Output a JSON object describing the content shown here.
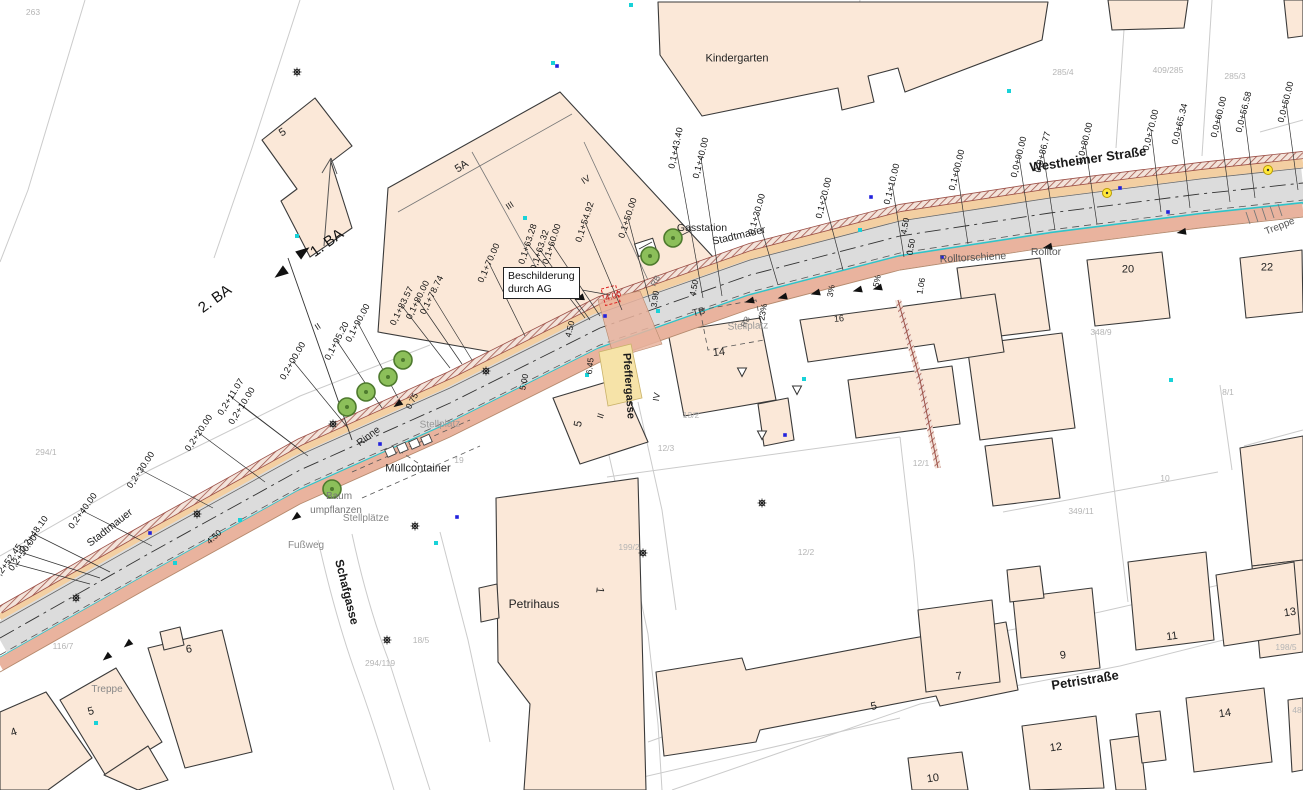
{
  "map": {
    "title": "Lageplan",
    "sign_box": {
      "line1": "Beschilderung",
      "line2": "durch AG",
      "x": 503,
      "y": 267,
      "w": 72,
      "h": 30
    },
    "streets": [
      {
        "label": "Westheimer Straße",
        "x": 1088,
        "y": 159,
        "rot": -8,
        "size": 13
      },
      {
        "label": "Petristraße",
        "x": 1085,
        "y": 680,
        "rot": -9,
        "size": 13
      },
      {
        "label": "Schafgasse",
        "x": 347,
        "y": 592,
        "rot": 76,
        "size": 12
      },
      {
        "label": "Pfeffergasse",
        "x": 628,
        "y": 386,
        "rot": 86,
        "size": 11
      }
    ],
    "stations": [
      {
        "label": "0,0+50.00",
        "x": 1286,
        "y": 102,
        "rot": -76,
        "lx": 1298,
        "ly": 190
      },
      {
        "label": "0,0+56.58",
        "x": 1244,
        "y": 112,
        "rot": -76,
        "lx": 1255,
        "ly": 198
      },
      {
        "label": "0,0+60.00",
        "x": 1219,
        "y": 117,
        "rot": -76,
        "lx": 1230,
        "ly": 202
      },
      {
        "label": "0,0+65.34",
        "x": 1180,
        "y": 124,
        "rot": -76,
        "lx": 1190,
        "ly": 208
      },
      {
        "label": "0,0+70.00",
        "x": 1151,
        "y": 130,
        "rot": -76,
        "lx": 1161,
        "ly": 212
      },
      {
        "label": "0,0+80.00",
        "x": 1085,
        "y": 143,
        "rot": -76,
        "lx": 1097,
        "ly": 224
      },
      {
        "label": "0,0+86.77",
        "x": 1043,
        "y": 152,
        "rot": -76,
        "lx": 1055,
        "ly": 230
      },
      {
        "label": "0,0+90.00",
        "x": 1019,
        "y": 157,
        "rot": -76,
        "lx": 1031,
        "ly": 234
      },
      {
        "label": "0,1+00.00",
        "x": 957,
        "y": 170,
        "rot": -76,
        "lx": 968,
        "ly": 244
      },
      {
        "label": "0,1+10.00",
        "x": 892,
        "y": 184,
        "rot": -76,
        "lx": 904,
        "ly": 257
      },
      {
        "label": "0,1+20.00",
        "x": 824,
        "y": 198,
        "rot": -76,
        "lx": 843,
        "ly": 270
      },
      {
        "label": "0,1+30.00",
        "x": 757,
        "y": 214,
        "rot": -74,
        "lx": 778,
        "ly": 285
      },
      {
        "label": "0,1+40.00",
        "x": 701,
        "y": 158,
        "rot": -76,
        "lx": 722,
        "ly": 296
      },
      {
        "label": "0,1+43.40",
        "x": 676,
        "y": 148,
        "rot": -78,
        "lx": 703,
        "ly": 298
      },
      {
        "label": "0,1+50.00",
        "x": 628,
        "y": 218,
        "rot": -72,
        "lx": 650,
        "ly": 302
      },
      {
        "label": "0,1+54.92",
        "x": 585,
        "y": 222,
        "rot": -72,
        "lx": 622,
        "ly": 310
      },
      {
        "label": "0,1+60.00",
        "x": 552,
        "y": 244,
        "rot": -72,
        "lx": 600,
        "ly": 316
      },
      {
        "label": "0,1+63.32",
        "x": 540,
        "y": 250,
        "rot": -72,
        "lx": 590,
        "ly": 320
      },
      {
        "label": "0,1+63.28",
        "x": 528,
        "y": 244,
        "rot": -72,
        "lx": 585,
        "ly": 318
      },
      {
        "label": "0,1+70.00",
        "x": 489,
        "y": 263,
        "rot": -66,
        "lx": 525,
        "ly": 336
      },
      {
        "label": "0,1+78.74",
        "x": 432,
        "y": 295,
        "rot": -64,
        "lx": 472,
        "ly": 360
      },
      {
        "label": "0,1+80.00",
        "x": 418,
        "y": 300,
        "rot": -64,
        "lx": 462,
        "ly": 364
      },
      {
        "label": "0,1+83.57",
        "x": 402,
        "y": 306,
        "rot": -64,
        "lx": 450,
        "ly": 368
      },
      {
        "label": "0,1+90.00",
        "x": 358,
        "y": 323,
        "rot": -62,
        "lx": 398,
        "ly": 398
      },
      {
        "label": "0,1+95.20",
        "x": 337,
        "y": 341,
        "rot": -62,
        "lx": 382,
        "ly": 408
      },
      {
        "label": "0,2+00.00",
        "x": 293,
        "y": 361,
        "rot": -60,
        "lx": 348,
        "ly": 428
      },
      {
        "label": "0,2+11.07",
        "x": 231,
        "y": 397,
        "rot": -58,
        "lx": 303,
        "ly": 452
      },
      {
        "label": "0,2+10.00",
        "x": 242,
        "y": 406,
        "rot": -58,
        "lx": 308,
        "ly": 456
      },
      {
        "label": "0,2+20.00",
        "x": 199,
        "y": 433,
        "rot": -56,
        "lx": 265,
        "ly": 482
      },
      {
        "label": "0,2+30.00",
        "x": 141,
        "y": 470,
        "rot": -56,
        "lx": 213,
        "ly": 508
      },
      {
        "label": "0,2+40.00",
        "x": 83,
        "y": 511,
        "rot": -54,
        "lx": 152,
        "ly": 546
      },
      {
        "label": "0,2+48.10",
        "x": 34,
        "y": 534,
        "rot": -54,
        "lx": 110,
        "ly": 572
      },
      {
        "label": "0,2+50.00",
        "x": 23,
        "y": 553,
        "rot": -54,
        "lx": 100,
        "ly": 578
      },
      {
        "label": "0,2+52.45",
        "x": 8,
        "y": 562,
        "rot": -54,
        "lx": 90,
        "ly": 584
      }
    ],
    "dimensions": [
      {
        "label": "4.50",
        "x": 905,
        "y": 226,
        "rot": -80
      },
      {
        "label": "0.50",
        "x": 911,
        "y": 247,
        "rot": -80
      },
      {
        "label": "1.06",
        "x": 921,
        "y": 286,
        "rot": -80
      },
      {
        "label": "4.50",
        "x": 694,
        "y": 288,
        "rot": -78
      },
      {
        "label": "3.90",
        "x": 655,
        "y": 299,
        "rot": -82
      },
      {
        "label": "4.00",
        "x": 613,
        "y": 296,
        "rot": -18,
        "color": "#cc2222"
      },
      {
        "label": "4.50",
        "x": 570,
        "y": 329,
        "rot": -76
      },
      {
        "label": "5.00",
        "x": 524,
        "y": 382,
        "rot": -78
      },
      {
        "label": "6.45",
        "x": 590,
        "y": 366,
        "rot": -84
      },
      {
        "label": "4.50",
        "x": 214,
        "y": 537,
        "rot": -42
      },
      {
        "label": "0.75",
        "x": 412,
        "y": 401,
        "rot": -62
      },
      {
        "label": "23%",
        "x": 763,
        "y": 312,
        "rot": -80
      },
      {
        "label": "3%",
        "x": 831,
        "y": 291,
        "rot": -80
      },
      {
        "label": "5%",
        "x": 877,
        "y": 281,
        "rot": -80
      }
    ],
    "annotations": [
      {
        "label": "Kindergarten",
        "x": 737,
        "y": 59,
        "rot": 0,
        "size": 11,
        "color": "#222"
      },
      {
        "label": "Gasstation",
        "x": 702,
        "y": 228,
        "rot": 0,
        "size": 10.5,
        "color": "#222"
      },
      {
        "label": "Stadtmauer",
        "x": 739,
        "y": 236,
        "rot": -13,
        "size": 10.5,
        "color": "#222"
      },
      {
        "label": "Stadtmauer",
        "x": 110,
        "y": 528,
        "rot": -38,
        "size": 10.5,
        "color": "#222"
      },
      {
        "label": "Rolltorschiene",
        "x": 973,
        "y": 258,
        "rot": -3,
        "size": 10.5,
        "color": "#555"
      },
      {
        "label": "Rolltor",
        "x": 1046,
        "y": 252,
        "rot": 0,
        "size": 10.5,
        "color": "#555"
      },
      {
        "label": "Treppe",
        "x": 1280,
        "y": 227,
        "rot": -22,
        "size": 10,
        "color": "#555"
      },
      {
        "label": "Treppe",
        "x": 107,
        "y": 690,
        "rot": 0,
        "size": 10,
        "color": "#888"
      },
      {
        "label": "Müllcontainer",
        "x": 418,
        "y": 469,
        "rot": 0,
        "size": 11,
        "color": "#222"
      },
      {
        "label": "Baum",
        "x": 339,
        "y": 497,
        "rot": 0,
        "size": 10,
        "color": "#777"
      },
      {
        "label": "umpflanzen",
        "x": 336,
        "y": 511,
        "rot": 0,
        "size": 10,
        "color": "#777"
      },
      {
        "label": "Stellplätze",
        "x": 366,
        "y": 519,
        "rot": 0,
        "size": 10,
        "color": "#888"
      },
      {
        "label": "Stellplatz",
        "x": 440,
        "y": 425,
        "rot": -2,
        "size": 10,
        "color": "#999"
      },
      {
        "label": "Stellplatz",
        "x": 748,
        "y": 327,
        "rot": -2,
        "size": 10,
        "color": "#999"
      },
      {
        "label": "Fußweg",
        "x": 306,
        "y": 546,
        "rot": 0,
        "size": 10,
        "color": "#888"
      },
      {
        "label": "Rinne",
        "x": 369,
        "y": 437,
        "rot": -37,
        "size": 10,
        "color": "#222"
      },
      {
        "label": "TB",
        "x": 699,
        "y": 313,
        "rot": -14,
        "size": 10,
        "color": "#333"
      },
      {
        "label": "Petrihaus",
        "x": 534,
        "y": 604,
        "rot": 0,
        "size": 12,
        "color": "#222"
      },
      {
        "label": "2. BA",
        "x": 215,
        "y": 299,
        "rot": -36,
        "size": 15,
        "color": "#111"
      },
      {
        "label": "1. BA",
        "x": 327,
        "y": 243,
        "rot": -36,
        "size": 15,
        "color": "#111"
      },
      {
        "label": "RB",
        "x": 656,
        "y": 281,
        "rot": -62,
        "size": 8,
        "color": "#666"
      },
      {
        "label": "RB",
        "x": 746,
        "y": 322,
        "rot": -62,
        "size": 8,
        "color": "#666"
      },
      {
        "label": "II",
        "x": 318,
        "y": 327,
        "rot": -33,
        "size": 9,
        "color": "#222"
      },
      {
        "label": "III",
        "x": 510,
        "y": 206,
        "rot": -33,
        "size": 9,
        "color": "#222"
      },
      {
        "label": "IV",
        "x": 586,
        "y": 180,
        "rot": -33,
        "size": 9,
        "color": "#222"
      },
      {
        "label": "IV",
        "x": 657,
        "y": 397,
        "rot": -80,
        "size": 9,
        "color": "#222"
      },
      {
        "label": "II",
        "x": 601,
        "y": 416,
        "rot": -72,
        "size": 9,
        "color": "#222"
      }
    ],
    "parcels": [
      {
        "label": "263",
        "x": 33,
        "y": 12
      },
      {
        "label": "285/4",
        "x": 1063,
        "y": 72
      },
      {
        "label": "409/285",
        "x": 1168,
        "y": 70
      },
      {
        "label": "285/3",
        "x": 1235,
        "y": 76
      },
      {
        "label": "348/9",
        "x": 1101,
        "y": 332
      },
      {
        "label": "8/1",
        "x": 1228,
        "y": 392
      },
      {
        "label": "349/11",
        "x": 1081,
        "y": 511
      },
      {
        "label": "10",
        "x": 1165,
        "y": 478
      },
      {
        "label": "13/2",
        "x": 691,
        "y": 415
      },
      {
        "label": "12/3",
        "x": 666,
        "y": 448
      },
      {
        "label": "12/2",
        "x": 806,
        "y": 552
      },
      {
        "label": "199/2",
        "x": 629,
        "y": 547
      },
      {
        "label": "12/1",
        "x": 921,
        "y": 463
      },
      {
        "label": "198/5",
        "x": 1286,
        "y": 647
      },
      {
        "label": "48",
        "x": 1297,
        "y": 710
      },
      {
        "label": "19",
        "x": 459,
        "y": 460
      },
      {
        "label": "18/5",
        "x": 421,
        "y": 640
      },
      {
        "label": "294/119",
        "x": 380,
        "y": 663
      },
      {
        "label": "294/1",
        "x": 46,
        "y": 452
      },
      {
        "label": "116/7",
        "x": 63,
        "y": 646
      }
    ],
    "houses": [
      {
        "label": "5",
        "x": 283,
        "y": 133,
        "rot": -33,
        "size": 11
      },
      {
        "label": "5A",
        "x": 462,
        "y": 167,
        "rot": -33,
        "size": 11
      },
      {
        "label": "14",
        "x": 719,
        "y": 353,
        "rot": -6,
        "size": 11
      },
      {
        "label": "16",
        "x": 839,
        "y": 319,
        "rot": -6,
        "size": 9
      },
      {
        "label": "20",
        "x": 1128,
        "y": 270,
        "rot": 0,
        "size": 11
      },
      {
        "label": "22",
        "x": 1267,
        "y": 268,
        "rot": 0,
        "size": 11
      },
      {
        "label": "5",
        "x": 579,
        "y": 424,
        "rot": -78,
        "size": 11
      },
      {
        "label": "6",
        "x": 189,
        "y": 650,
        "rot": -8,
        "size": 11
      },
      {
        "label": "5",
        "x": 91,
        "y": 712,
        "rot": -15,
        "size": 11
      },
      {
        "label": "4",
        "x": 14,
        "y": 733,
        "rot": -20,
        "size": 11
      },
      {
        "label": "1",
        "x": 599,
        "y": 590,
        "rot": 96,
        "size": 11
      },
      {
        "label": "7",
        "x": 959,
        "y": 677,
        "rot": -8,
        "size": 11
      },
      {
        "label": "9",
        "x": 1063,
        "y": 656,
        "rot": -8,
        "size": 11
      },
      {
        "label": "11",
        "x": 1172,
        "y": 637,
        "rot": -8,
        "size": 11
      },
      {
        "label": "13",
        "x": 1290,
        "y": 613,
        "rot": -8,
        "size": 11
      },
      {
        "label": "12",
        "x": 1056,
        "y": 748,
        "rot": -8,
        "size": 11
      },
      {
        "label": "14",
        "x": 1225,
        "y": 714,
        "rot": -8,
        "size": 11
      },
      {
        "label": "10",
        "x": 933,
        "y": 779,
        "rot": -8,
        "size": 11
      },
      {
        "label": "5",
        "x": 874,
        "y": 707,
        "rot": -12,
        "size": 11
      }
    ],
    "trees": [
      [
        673,
        238
      ],
      [
        650,
        256
      ],
      [
        403,
        360
      ],
      [
        388,
        377
      ],
      [
        366,
        392
      ],
      [
        347,
        407
      ],
      [
        332,
        489
      ]
    ],
    "lamps": [
      [
        297,
        72
      ],
      [
        333,
        424
      ],
      [
        415,
        526
      ],
      [
        387,
        640
      ],
      [
        197,
        514
      ],
      [
        76,
        598
      ],
      [
        762,
        503
      ],
      [
        643,
        553
      ],
      [
        486,
        371
      ]
    ],
    "street_lights": [
      [
        1107,
        193
      ],
      [
        1268,
        170
      ]
    ],
    "dots_cyan": [
      [
        631,
        5
      ],
      [
        553,
        63
      ],
      [
        297,
        236
      ],
      [
        525,
        218
      ],
      [
        587,
        375
      ],
      [
        658,
        311
      ],
      [
        804,
        379
      ],
      [
        1171,
        380
      ],
      [
        240,
        520
      ],
      [
        436,
        543
      ],
      [
        96,
        723
      ],
      [
        175,
        563
      ],
      [
        1009,
        91
      ],
      [
        860,
        230
      ]
    ],
    "dots_blue": [
      [
        557,
        66
      ],
      [
        150,
        533
      ],
      [
        457,
        517
      ],
      [
        871,
        197
      ],
      [
        1168,
        212
      ],
      [
        942,
        257
      ],
      [
        605,
        316
      ],
      [
        380,
        444
      ],
      [
        785,
        435
      ],
      [
        1120,
        188
      ]
    ],
    "flow_arrows": [
      [
        750,
        301,
        -15
      ],
      [
        783,
        297,
        -15
      ],
      [
        816,
        293,
        -15
      ],
      [
        858,
        290,
        -15
      ],
      [
        878,
        288,
        -15
      ],
      [
        1048,
        247,
        -12
      ],
      [
        1182,
        232,
        -10
      ],
      [
        580,
        298,
        -18
      ],
      [
        296,
        517,
        -38
      ],
      [
        107,
        657,
        -40
      ],
      [
        128,
        644,
        -40
      ],
      [
        398,
        404,
        -35
      ]
    ],
    "open_arrows": [
      [
        797,
        390
      ],
      [
        742,
        372
      ],
      [
        762,
        435
      ]
    ],
    "colors": {
      "building_fill": "#fbe8d8",
      "building_stroke": "#3a3a3a",
      "road_gray": "#dcdcdc",
      "sidewalk_tan": "#f3cfa2",
      "new_path_salmon": "#e9b39e",
      "wall_hatch": "#a2564c",
      "gutter_cyan": "#2fc4c9",
      "parcel_line": "#cbcbcb",
      "tree_green": "#8cbf5a",
      "lamp_yellow": "#ffe83a",
      "dimension_red": "#cc2222"
    }
  }
}
